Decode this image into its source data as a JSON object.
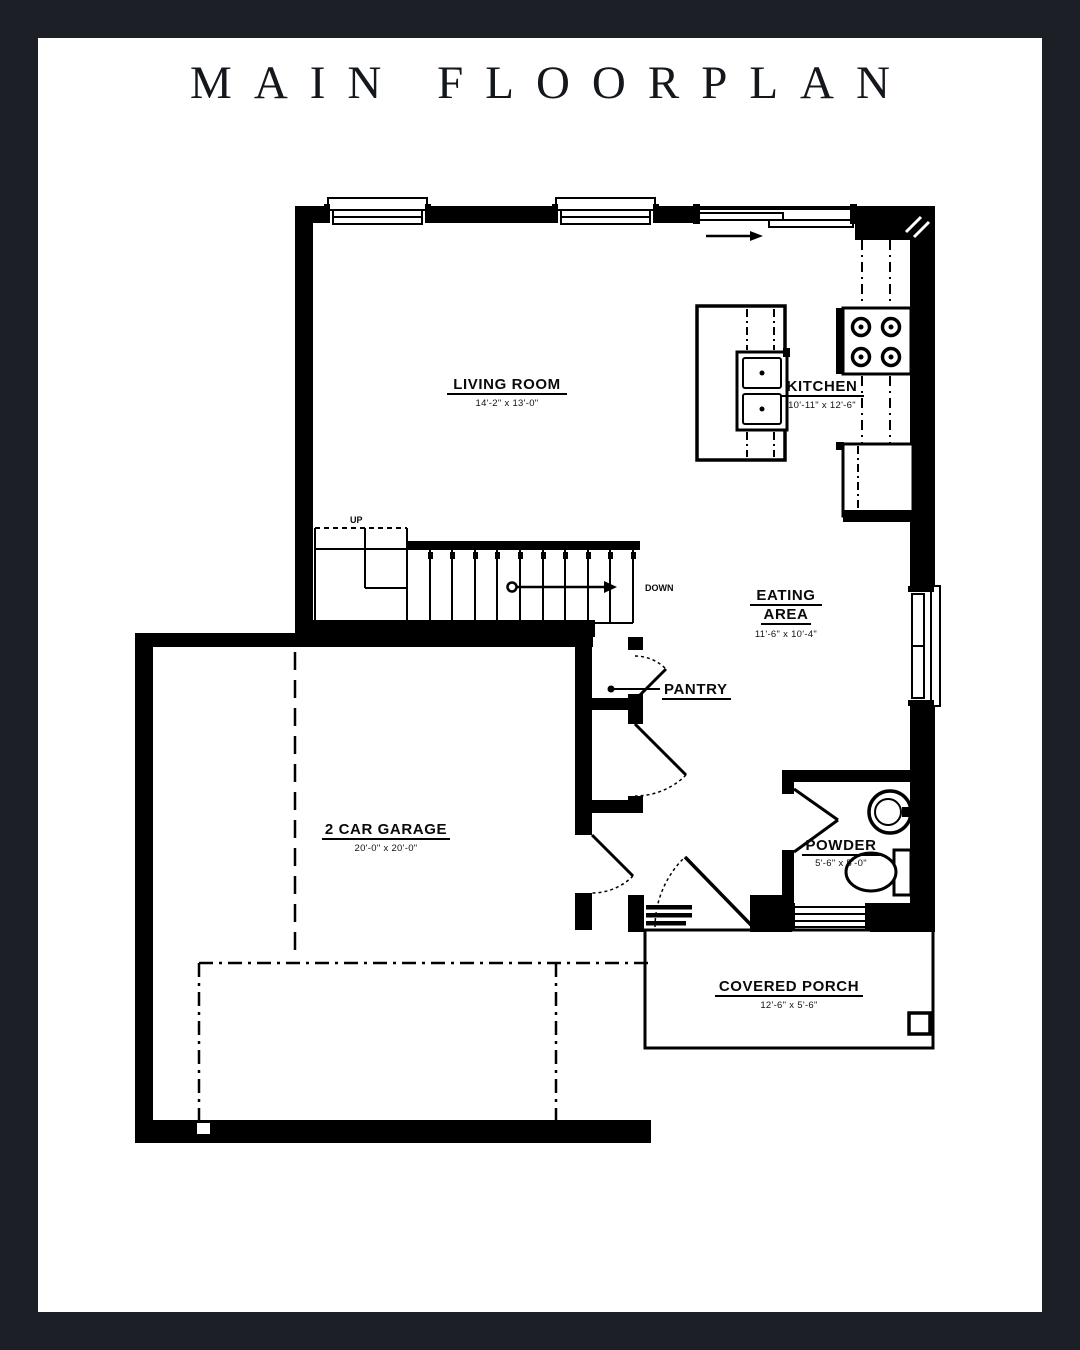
{
  "page": {
    "title": "MAIN FLOORPLAN"
  },
  "rooms": {
    "living": {
      "name": "LIVING ROOM",
      "dims": "14'-2\" x 13'-0\""
    },
    "kitchen": {
      "name": "KITCHEN",
      "dims": "10'-11\" x 12'-6\""
    },
    "eating": {
      "name1": "EATING",
      "name2": "AREA",
      "dims": "11'-6\" x 10'-4\""
    },
    "pantry": {
      "name": "PANTRY"
    },
    "garage": {
      "name": "2 CAR GARAGE",
      "dims": "20'-0\" x 20'-0\""
    },
    "powder": {
      "name": "POWDER",
      "dims": "5'-6\" x 5'-0\""
    },
    "porch": {
      "name": "COVERED PORCH",
      "dims": "12'-6\" x 5'-6\""
    }
  },
  "stairs": {
    "up": "UP",
    "down": "DOWN"
  },
  "colors": {
    "frame": "#1c1f26",
    "paper": "#ffffff",
    "ink": "#000000"
  }
}
